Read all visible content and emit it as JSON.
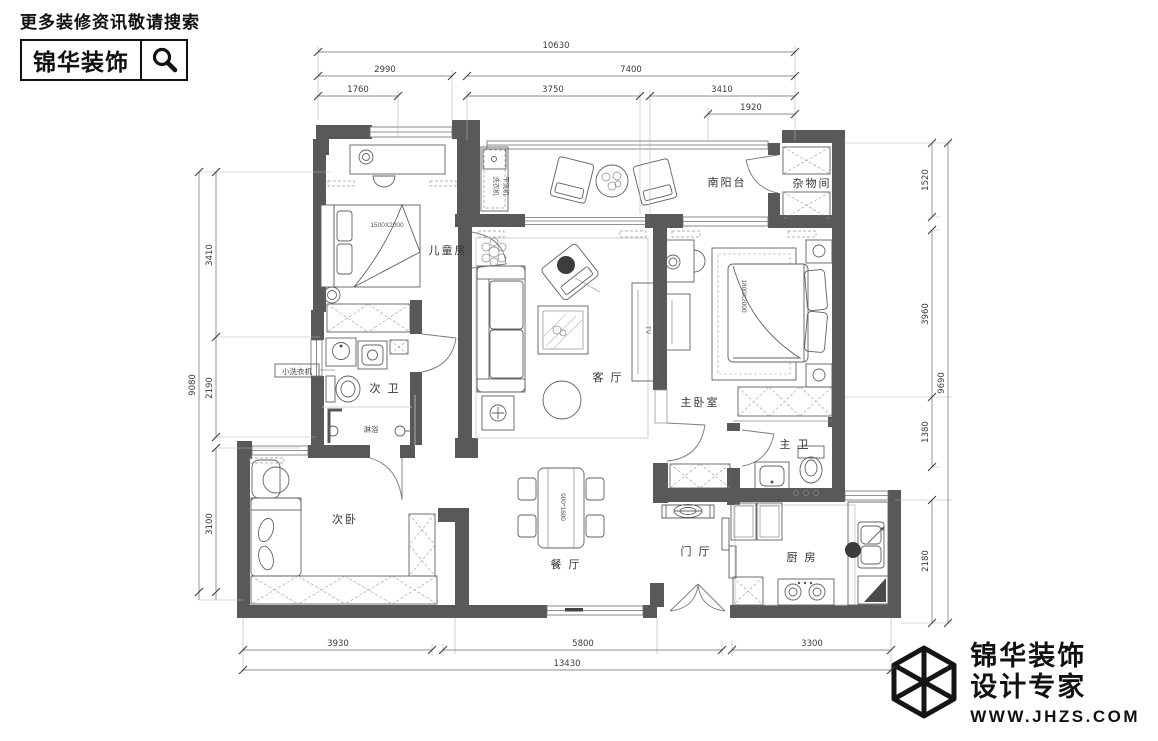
{
  "header": {
    "tagline": "更多装修资讯敬请搜索",
    "brand": "锦华装饰"
  },
  "footer": {
    "brand_line1": "锦华装饰",
    "brand_line2": "设计专家",
    "website": "WWW.JHZS.COM"
  },
  "rooms": {
    "children": "儿童房",
    "balcony": "南阳台",
    "storage": "杂物间",
    "living": "客 厅",
    "master": "主卧室",
    "master_bath": "主 卫",
    "second_bath": "次 卫",
    "second_bed": "次卧",
    "dining": "餐 厅",
    "foyer": "门 厅",
    "kitchen": "厨 房"
  },
  "labels": {
    "child_bed_size": "1500X2000",
    "master_bed_size": "1800X2000",
    "dining_table_size": "900*1600",
    "washer": "洗衣机",
    "dryer": "干洗机",
    "small_washer": "小洗衣机",
    "shower": "淋浴",
    "tv": "TV"
  },
  "dims": {
    "top_total": "10630",
    "top_l": "2990",
    "top_r": "7400",
    "top_a": "1760",
    "top_b": "3750",
    "top_c": "3410",
    "top_d": "1920",
    "left_total": "9080",
    "left_a": "3410",
    "left_b": "2190",
    "left_c": "3100",
    "right_a": "1520",
    "right_b": "3960",
    "right_c": "1380",
    "right_d": "2180",
    "right_total": "9690",
    "bottom_a": "3930",
    "bottom_b": "5800",
    "bottom_c": "3300",
    "bottom_total": "13430"
  },
  "colors": {
    "wall": "#58595b",
    "line": "#6b6b6b",
    "ink": "#111111"
  }
}
